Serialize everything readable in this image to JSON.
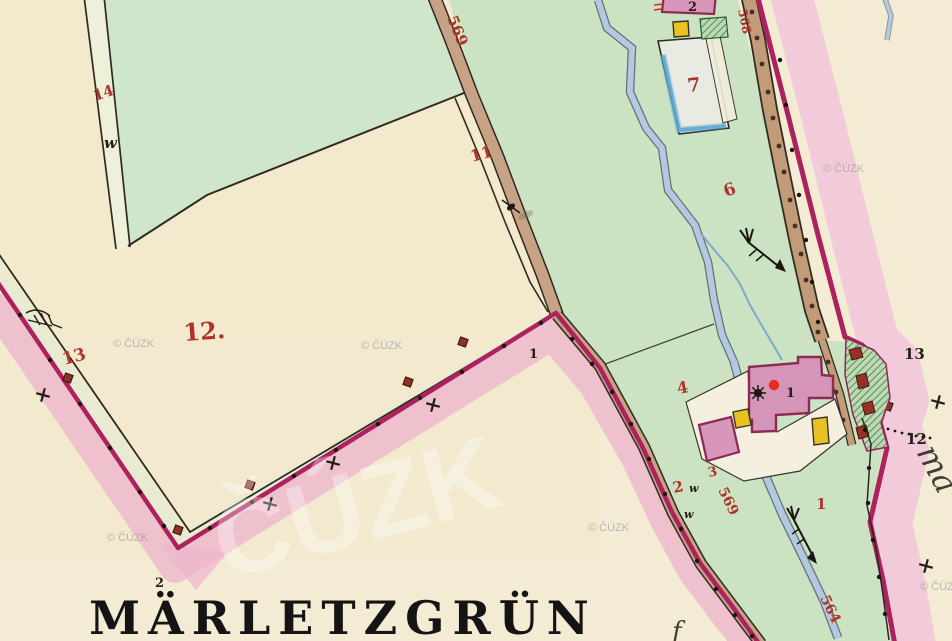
{
  "map": {
    "title": "MÄRLETZGRÜN",
    "title_note": "2",
    "watermark": "© ČÚZK",
    "watermark_large": "ČÚZK",
    "parcels_red": {
      "p1": "1",
      "p2": "2",
      "p3": "3",
      "p4": "4",
      "p6": "6",
      "p7": "7",
      "p11": "11",
      "p12": "12.",
      "p13": "13",
      "p14": "14"
    },
    "roads_red": {
      "r569_top": "569",
      "r569_low": "569",
      "r568": "568",
      "r564": "564"
    },
    "marks_black": {
      "stone1": "1",
      "stone12": "12",
      "stone13": "13",
      "house1": "1",
      "house2": "2"
    },
    "meadow_mark": "w",
    "script_right": "ma",
    "script_bottom": "f",
    "colors": {
      "paper_cream": "#f3ebd3",
      "field_green": "#cbe3c3",
      "boundary_crimson": "#ad215f",
      "boundary_band_pink": "#eeb6cd",
      "road_tan": "#c7a284",
      "water_blue": "#aac4e0",
      "building_pink": "#d697ba",
      "building_yellow": "#e7c221",
      "parcel_number_red": "#ae3428",
      "marker_red": "#e62e1e",
      "watermark_grey": "#8b95a3"
    }
  }
}
